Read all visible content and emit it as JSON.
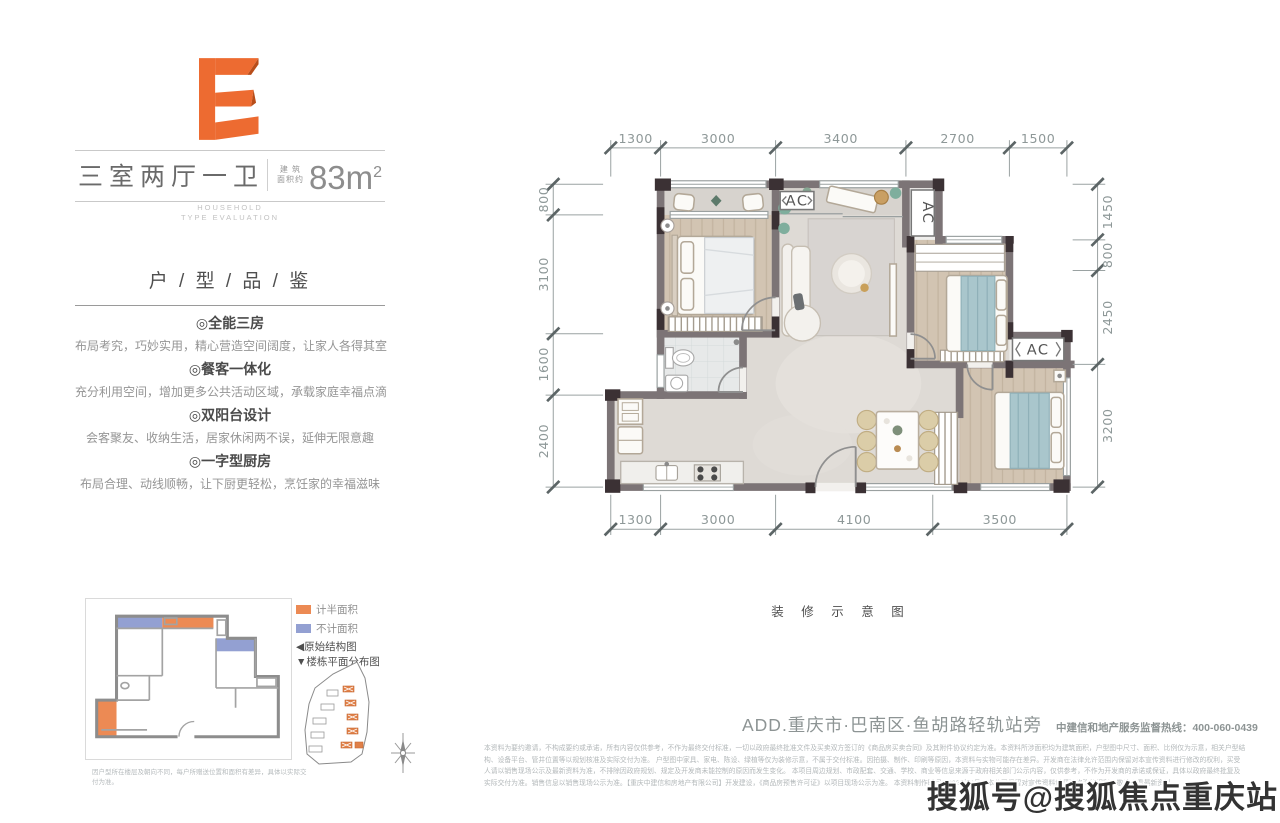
{
  "accent": {
    "orange": "#ed6b31",
    "orange_dark": "#b84d1a",
    "blue": "#93a0d2",
    "legend_orange": "#ec8a54",
    "wall_gray": "#7c7476",
    "wall_dark": "#3b3134",
    "bed_teal": "#a9c6cc"
  },
  "unit_card": {
    "letter": "E",
    "title": "三室两厅一卫",
    "area_prefix_top": "建 筑",
    "area_prefix_bottom": "面积约",
    "area_value": "83m",
    "area_sup": "2",
    "subtitle_en_1": "HOUSEHOLD",
    "subtitle_en_2": "TYPE EVALUATION",
    "section_title": "户 / 型 / 品 / 鉴",
    "features": [
      {
        "title": "◎全能三房",
        "desc": "布局考究，巧妙实用，精心营造空间阔度，让家人各得其室"
      },
      {
        "title": "◎餐客一体化",
        "desc": "充分利用空间，增加更多公共活动区域，承载家庭幸福点滴"
      },
      {
        "title": "◎双阳台设计",
        "desc": "会客聚友、收纳生活，居家休闲两不误，延伸无限意趣"
      },
      {
        "title": "◎一字型厨房",
        "desc": "布局合理、动线顺畅，让下厨更轻松，烹饪家的幸福滋味"
      }
    ]
  },
  "mini_plan": {
    "legend": [
      {
        "label": "计半面积",
        "color": "#ec8a54"
      },
      {
        "label": "不计面积",
        "color": "#93a0d2"
      }
    ],
    "links": [
      "◀原始结构图",
      "▼楼栋平面分布图"
    ],
    "note": "因户型所在楼层及朝向不同，每户所赠送位置和面积有差异，具体以实际交付为准。"
  },
  "floor_plan": {
    "caption": "装 修 示 意 图",
    "ac_label": "AC",
    "dims": {
      "top": [
        1300,
        3000,
        3400,
        2700,
        1500
      ],
      "bottom": [
        1300,
        3000,
        4100,
        3500
      ],
      "left": [
        800,
        3100,
        1600,
        2400
      ],
      "right": [
        1450,
        800,
        2450,
        3200
      ]
    }
  },
  "footer": {
    "address": "ADD.重庆市·巴南区·鱼胡路轻轨站旁",
    "hotline": "中建信和地产服务监督热线：400-060-0439",
    "disclaimer_lines": [
      "本资料为要约邀请，不构成要约或承诺，所有内容仅供参考，不作为最终交付标准，一切以政府最终批准文件及买卖双方签订的《商品房买卖合同》及其附件协议约定为准。本资料所涉面积均为建筑面积，户型图中尺寸、面积、比例仅为示意，相关户型结构、设备平台、管井位置等以规划核准及实际交付为准。",
      "户型图中家具、家电、陈设、绿植等仅为装修示意，不属于交付标准。因拍摄、制作、印刷等原因，本资料与实物可能存在差异。开发商在法律允许范围内保留对本宣传资料进行修改的权利，买受人请以销售现场公示及最新资料为准，不排除因政府规划、规定及开发商未能控制的原因而发生变化。",
      "本项目周边规划、市政配套、交通、学校、商业等信息来源于政府相关部门公示内容，仅供参考，不作为开发商的承诺或保证，具体以政府最终批复及实际交付为准。销售信息以销售现场公示为准。【重庆中建信和房地产有限公司】开发建设，《商品房预售许可证》以项目现场公示为准。",
      "本资料制作时间：2025年6月，本公司保留对宣传资料解释及修改的权利，敬请查看最新资料。"
    ]
  },
  "watermark": "搜狐号@搜狐焦点重庆站"
}
